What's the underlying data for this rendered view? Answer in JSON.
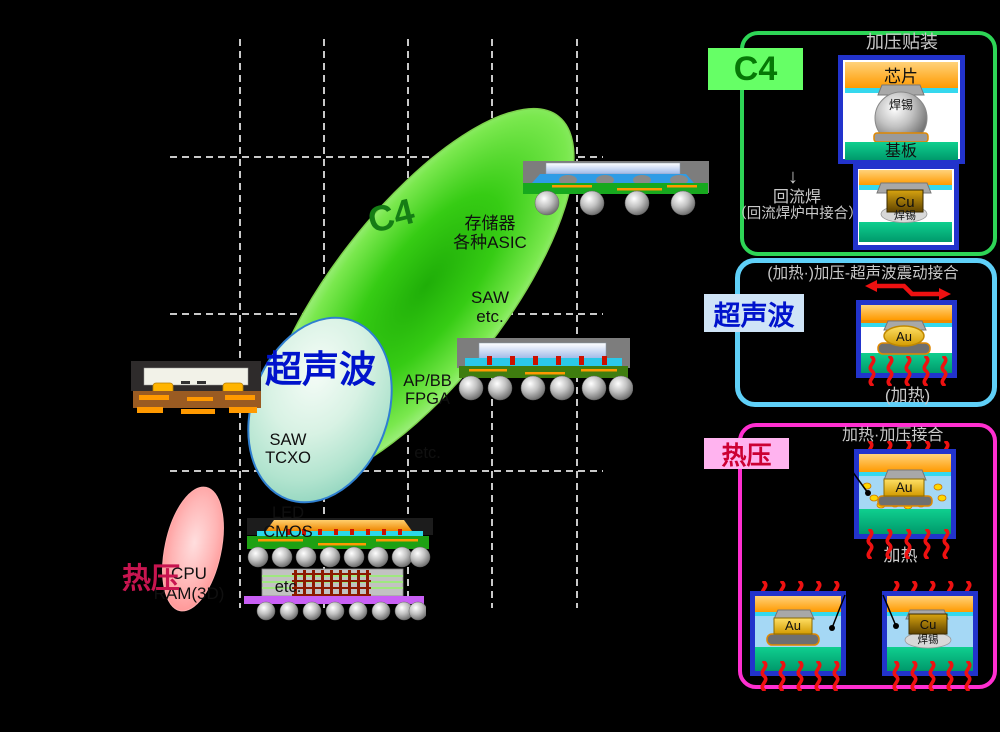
{
  "plot": {
    "c4": {
      "label": "C4",
      "items": [
        "存储器",
        "各种ASIC",
        "SAW",
        "etc."
      ],
      "sub_items": [
        "AP/BB",
        "FPGA",
        "etc."
      ],
      "bubble_color": "#3ecf1c"
    },
    "ultrasonic": {
      "label": "超声波",
      "items": [
        "SAW",
        "TCXO",
        "LED",
        "CMOS",
        "etc."
      ],
      "bubble_color": "#9fdcc4"
    },
    "thermo": {
      "label": "热压",
      "items": [
        "CPU",
        "RAM(3D)"
      ],
      "bubble_color": "#ff9f9f"
    }
  },
  "legend": {
    "c4": {
      "label": "C4",
      "title": "加压贴装",
      "top_diagram": {
        "die": "芯片",
        "solder": "焊锡",
        "substrate": "基板"
      },
      "arrow": "↓",
      "reflow_line1": "回流焊",
      "reflow_line2": "（回流焊炉中接合）",
      "bottom_diagram": {
        "pillar": "Cu",
        "solder": "焊锡"
      }
    },
    "ultrasonic": {
      "label": "超声波",
      "title": "(加热·)加压-超声波震动接合",
      "bump": "Au",
      "note": "(加热)"
    },
    "thermo": {
      "label": "热压",
      "title": "加热·加压接合",
      "bump": "Au",
      "note": "加热",
      "bottom_left": {
        "bump": "Au"
      },
      "bottom_right": {
        "pillar": "Cu",
        "solder": "焊锡"
      }
    }
  },
  "colors": {
    "c4_accent": "#2ed556",
    "ultrasonic_accent": "#5fd0f8",
    "thermo_accent": "#ff2fd0",
    "heat_wave": "#ee1111",
    "grid": "#c9c9c9",
    "background": "#000000"
  }
}
